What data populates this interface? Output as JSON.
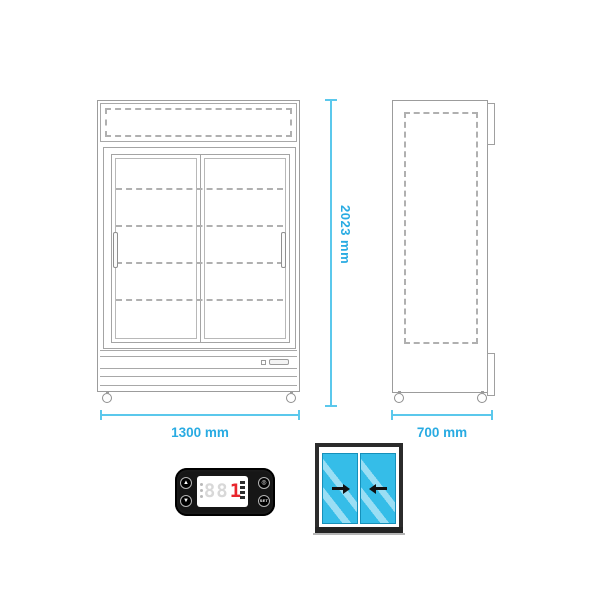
{
  "dimensions": {
    "height": "2023 mm",
    "width": "1300 mm",
    "depth": "700 mm"
  },
  "controller": {
    "ghost_digits": "88",
    "active_digit": "1",
    "buttons": {
      "up": "▲",
      "down": "▼",
      "power": "◎",
      "set": "SET"
    }
  },
  "colors": {
    "outline_gray": "#9c9c9c",
    "dimension_line": "#5bc8ec",
    "dimension_text": "#29abe2",
    "door_glass": "#35bde8",
    "controller_body": "#161616",
    "display_digit_red": "#e8262d",
    "display_ghost": "#d8d8d8"
  }
}
